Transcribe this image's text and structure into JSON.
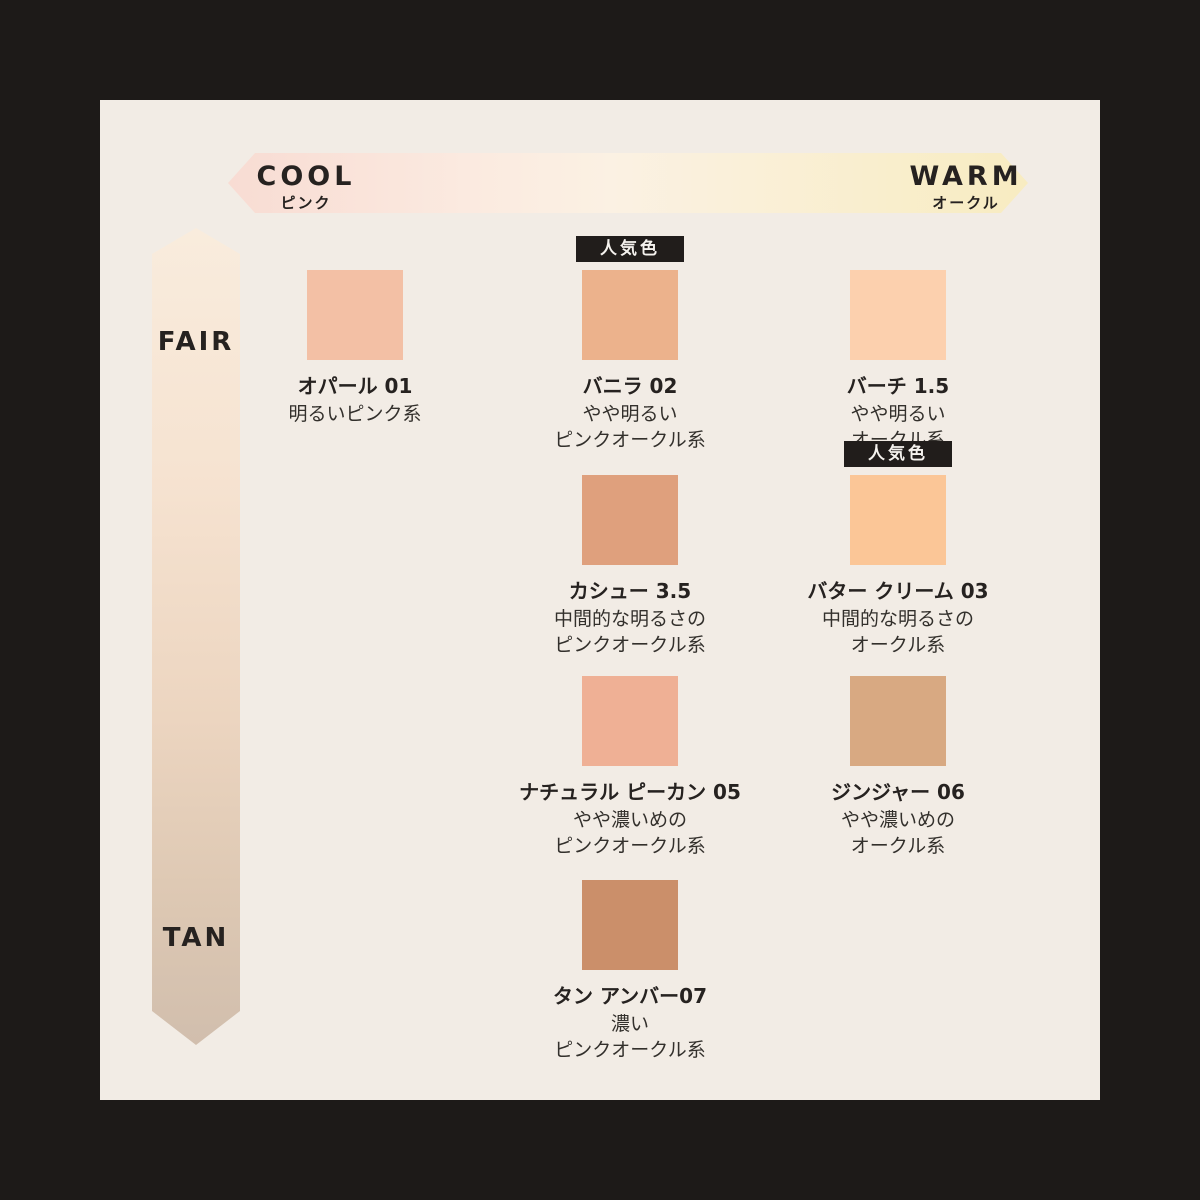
{
  "page": {
    "background": "#1d1a18",
    "panel_background": "#f2ece5"
  },
  "axes": {
    "horizontal": {
      "left_label": "COOL",
      "left_sublabel": "ピンク",
      "right_label": "WARM",
      "right_sublabel": "オークル",
      "gradient": "linear-gradient(90deg,#f8dcd3 0%,#fbeae0 30%,#fbf1e3 48%,#faf0da 62%,#f8ecc1 100%)"
    },
    "vertical": {
      "top_label": "FAIR",
      "bottom_label": "TAN",
      "gradient": "linear-gradient(180deg,#f9ecdd 0%,#f6e3d1 30%,#ecd5c0 60%,#ddc8b3 82%,#d1bead 100%)"
    }
  },
  "badge_label": "人気色",
  "shades": [
    {
      "name": "オパール 01",
      "desc1": "明るいピンク系",
      "desc2": "",
      "color": "#f3c0a5",
      "popular": false
    },
    {
      "name": "バニラ 02",
      "desc1": "やや明るい",
      "desc2": "ピンクオークル系",
      "color": "#ecb28c",
      "popular": true
    },
    {
      "name": "バーチ 1.5",
      "desc1": "やや明るい",
      "desc2": "オークル系",
      "color": "#fcd0ae",
      "popular": false
    },
    {
      "name": "カシュー 3.5",
      "desc1": "中間的な明るさの",
      "desc2": "ピンクオークル系",
      "color": "#dfa07d",
      "popular": false
    },
    {
      "name": "バター クリーム 03",
      "desc1": "中間的な明るさの",
      "desc2": "オークル系",
      "color": "#fbc697",
      "popular": true
    },
    {
      "name": "ナチュラル ピーカン 05",
      "desc1": "やや濃いめの",
      "desc2": "ピンクオークル系",
      "color": "#efb095",
      "popular": false
    },
    {
      "name": "ジンジャー 06",
      "desc1": "やや濃いめの",
      "desc2": "オークル系",
      "color": "#d8a982",
      "popular": false
    },
    {
      "name": "タン アンバー07",
      "desc1": "濃い",
      "desc2": "ピンクオークル系",
      "color": "#cb8f6a",
      "popular": false
    }
  ]
}
